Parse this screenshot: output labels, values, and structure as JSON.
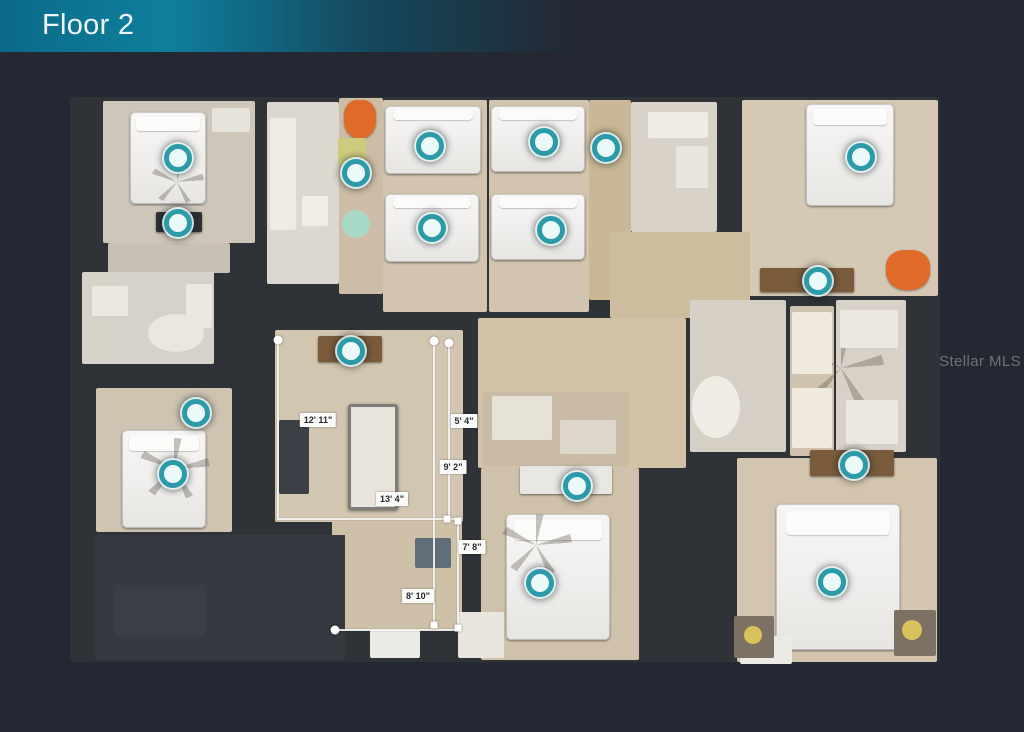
{
  "header": {
    "title": "Floor 2"
  },
  "watermark": {
    "text": "Stellar MLS"
  },
  "colors": {
    "background": "#232833",
    "banner_teal": "#0f7f9e",
    "wall_dark": "#2f3237",
    "floor_beige": "#d2c4ae",
    "marker_teal": "#2c9aa9",
    "measure_white": "#f4f4f2",
    "accent_orange": "#e06b28",
    "accent_red": "#d31520"
  },
  "plan": {
    "footprint": {
      "x": 70,
      "y": 97,
      "w": 870,
      "h": 565
    },
    "rooms": [
      {
        "name": "bedroom-top-left",
        "x": 103,
        "y": 101,
        "w": 152,
        "h": 142,
        "color": "#cfc6ba"
      },
      {
        "name": "hall-top-left-lower",
        "x": 108,
        "y": 243,
        "w": 122,
        "h": 30,
        "color": "#c9c0b4"
      },
      {
        "name": "bathroom-left",
        "x": 82,
        "y": 272,
        "w": 132,
        "h": 92,
        "color": "#d6d1c9"
      },
      {
        "name": "bedroom-bottom-left",
        "x": 96,
        "y": 388,
        "w": 136,
        "h": 144,
        "color": "#cfc3b2"
      },
      {
        "name": "bathroom-center-left",
        "x": 267,
        "y": 102,
        "w": 72,
        "h": 182,
        "color": "#dcd7cf"
      },
      {
        "name": "hall-top-center",
        "x": 339,
        "y": 98,
        "w": 44,
        "h": 196,
        "color": "#cdbda6"
      },
      {
        "name": "bedroom-mid-left",
        "x": 383,
        "y": 100,
        "w": 104,
        "h": 212,
        "color": "#d2c4ae"
      },
      {
        "name": "bedroom-mid",
        "x": 489,
        "y": 100,
        "w": 100,
        "h": 212,
        "color": "#d2c4ae"
      },
      {
        "name": "hall-mid",
        "x": 589,
        "y": 100,
        "w": 42,
        "h": 200,
        "color": "#c9b795"
      },
      {
        "name": "bathroom-top-right",
        "x": 631,
        "y": 102,
        "w": 86,
        "h": 130,
        "color": "#d8d2c8"
      },
      {
        "name": "bedroom-top-right",
        "x": 742,
        "y": 100,
        "w": 196,
        "h": 196,
        "color": "#d5c8b4"
      },
      {
        "name": "hall-upper-right",
        "x": 610,
        "y": 232,
        "w": 140,
        "h": 86,
        "color": "#cdbd9f"
      },
      {
        "name": "loft",
        "x": 275,
        "y": 330,
        "w": 188,
        "h": 192,
        "color": "#d3c6b0"
      },
      {
        "name": "loft-lower",
        "x": 332,
        "y": 520,
        "w": 130,
        "h": 110,
        "color": "#cfc0a8"
      },
      {
        "name": "corridor-center",
        "x": 478,
        "y": 318,
        "w": 208,
        "h": 150,
        "color": "#d2c2a6"
      },
      {
        "name": "bathroom-bottom-center",
        "x": 483,
        "y": 392,
        "w": 146,
        "h": 74,
        "color": "#cabca4"
      },
      {
        "name": "bedroom-bottom-center",
        "x": 481,
        "y": 468,
        "w": 158,
        "h": 192,
        "color": "#d0c2aa"
      },
      {
        "name": "bath-suite-left",
        "x": 690,
        "y": 300,
        "w": 96,
        "h": 152,
        "color": "#d5cfc5"
      },
      {
        "name": "bath-suite-vanity",
        "x": 790,
        "y": 306,
        "w": 44,
        "h": 150,
        "color": "#cfc3ae"
      },
      {
        "name": "bath-suite-right",
        "x": 836,
        "y": 300,
        "w": 70,
        "h": 152,
        "color": "#d7d1c7"
      },
      {
        "name": "bedroom-bottom-right",
        "x": 737,
        "y": 458,
        "w": 200,
        "h": 204,
        "color": "#d3c5ae"
      }
    ],
    "furniture": [
      {
        "type": "patch",
        "name": "attic-roof-area",
        "x": 95,
        "y": 535,
        "w": 250,
        "h": 125,
        "color": "#36393f"
      },
      {
        "type": "stairs",
        "name": "stairwell",
        "x": 115,
        "y": 585,
        "w": 90,
        "h": 52,
        "color": "#3b3e44"
      },
      {
        "type": "bed",
        "name": "bed",
        "x": 130,
        "y": 112,
        "w": 76,
        "h": 92
      },
      {
        "type": "bed",
        "name": "bed",
        "x": 385,
        "y": 106,
        "w": 96,
        "h": 68
      },
      {
        "type": "bed",
        "name": "bed",
        "x": 385,
        "y": 194,
        "w": 94,
        "h": 68
      },
      {
        "type": "bed",
        "name": "bed",
        "x": 491,
        "y": 106,
        "w": 94,
        "h": 66
      },
      {
        "type": "bed",
        "name": "bed",
        "x": 491,
        "y": 194,
        "w": 94,
        "h": 66
      },
      {
        "type": "bed",
        "name": "bed",
        "x": 806,
        "y": 104,
        "w": 88,
        "h": 102
      },
      {
        "type": "bed",
        "name": "bed",
        "x": 122,
        "y": 430,
        "w": 84,
        "h": 98
      },
      {
        "type": "bed",
        "name": "bed",
        "x": 506,
        "y": 514,
        "w": 104,
        "h": 126
      },
      {
        "type": "bed",
        "name": "bed",
        "x": 776,
        "y": 504,
        "w": 124,
        "h": 146
      },
      {
        "type": "fan",
        "name": "ceiling-fan-shadow",
        "x": 150,
        "y": 160,
        "w": 54,
        "h": 44
      },
      {
        "type": "fan",
        "name": "ceiling-fan-shadow",
        "x": 798,
        "y": 330,
        "w": 86,
        "h": 76
      },
      {
        "type": "fan",
        "name": "ceiling-fan-shadow",
        "x": 138,
        "y": 438,
        "w": 72,
        "h": 62
      },
      {
        "type": "fan",
        "name": "ceiling-fan-shadow",
        "x": 500,
        "y": 514,
        "w": 72,
        "h": 62
      },
      {
        "type": "desk",
        "name": "dresser",
        "x": 156,
        "y": 212,
        "w": 46,
        "h": 20,
        "color": "#2e3134"
      },
      {
        "type": "desk",
        "name": "loft-desk",
        "x": 318,
        "y": 336,
        "w": 64,
        "h": 26,
        "color": "#7a5c3c"
      },
      {
        "type": "desk",
        "name": "desk",
        "x": 760,
        "y": 268,
        "w": 94,
        "h": 24,
        "color": "#7a5c3c"
      },
      {
        "type": "desk",
        "name": "desk",
        "x": 810,
        "y": 450,
        "w": 84,
        "h": 26,
        "color": "#7a5c3c"
      },
      {
        "type": "desk",
        "name": "desk",
        "x": 520,
        "y": 466,
        "w": 92,
        "h": 28,
        "color": "#e9e7e1"
      },
      {
        "type": "table",
        "name": "pool-table",
        "x": 348,
        "y": 404,
        "w": 50,
        "h": 106,
        "color": "#e8e4dc"
      },
      {
        "type": "shelf",
        "name": "shelf",
        "x": 279,
        "y": 420,
        "w": 30,
        "h": 74,
        "color": "#3c4046"
      },
      {
        "type": "cabinet",
        "name": "cabinet",
        "x": 415,
        "y": 538,
        "w": 36,
        "h": 30,
        "color": "#5f6e78"
      },
      {
        "type": "chair",
        "name": "orange-chair",
        "x": 344,
        "y": 100,
        "w": 32,
        "h": 38,
        "color": "#e06b28"
      },
      {
        "type": "chair",
        "name": "orange-chair",
        "x": 886,
        "y": 250,
        "w": 44,
        "h": 40,
        "color": "#e06b28"
      },
      {
        "type": "flower",
        "name": "red-flower-rug",
        "x": 584,
        "y": 184,
        "w": 46,
        "h": 50,
        "color": "#d31520"
      },
      {
        "type": "stool",
        "name": "green-stool",
        "x": 342,
        "y": 210,
        "w": 28,
        "h": 28,
        "color": "#a8d8c6"
      },
      {
        "type": "mat",
        "name": "yellow-mat",
        "x": 338,
        "y": 138,
        "w": 28,
        "h": 26,
        "color": "#cfcb7e"
      },
      {
        "type": "tub",
        "name": "bathtub",
        "x": 692,
        "y": 376,
        "w": 48,
        "h": 62,
        "color": "#efece6"
      },
      {
        "type": "tub",
        "name": "bathtub",
        "x": 148,
        "y": 314,
        "w": 56,
        "h": 38,
        "color": "#eae7e1"
      },
      {
        "type": "fixture",
        "name": "bath-fixture",
        "x": 92,
        "y": 286,
        "w": 36,
        "h": 30,
        "color": "#ebe8e2"
      },
      {
        "type": "fixture",
        "name": "bath-fixture",
        "x": 186,
        "y": 284,
        "w": 26,
        "h": 44,
        "color": "#ebe8e2"
      },
      {
        "type": "fixture",
        "name": "bath-counter",
        "x": 270,
        "y": 118,
        "w": 26,
        "h": 112,
        "color": "#eeebe5"
      },
      {
        "type": "fixture",
        "name": "toilet",
        "x": 302,
        "y": 196,
        "w": 26,
        "h": 30,
        "color": "#f0ede7"
      },
      {
        "type": "fixture",
        "name": "bath-counter",
        "x": 648,
        "y": 112,
        "w": 60,
        "h": 26,
        "color": "#efece6"
      },
      {
        "type": "fixture",
        "name": "shower",
        "x": 676,
        "y": 146,
        "w": 32,
        "h": 42,
        "color": "#e9e6df"
      },
      {
        "type": "fixture",
        "name": "shower",
        "x": 492,
        "y": 396,
        "w": 60,
        "h": 44,
        "color": "#e7e2d8"
      },
      {
        "type": "fixture",
        "name": "bath-fixture",
        "x": 560,
        "y": 420,
        "w": 56,
        "h": 34,
        "color": "#ded8cc"
      },
      {
        "type": "vanity",
        "name": "vanity",
        "x": 792,
        "y": 312,
        "w": 40,
        "h": 62,
        "color": "#efe9de"
      },
      {
        "type": "vanity",
        "name": "vanity",
        "x": 792,
        "y": 388,
        "w": 40,
        "h": 60,
        "color": "#efe9de"
      },
      {
        "type": "fixture",
        "name": "bath-fixture",
        "x": 840,
        "y": 310,
        "w": 58,
        "h": 38,
        "color": "#ece8e0"
      },
      {
        "type": "fixture",
        "name": "bath-fixture",
        "x": 846,
        "y": 400,
        "w": 52,
        "h": 44,
        "color": "#ece8e0"
      },
      {
        "type": "fixture",
        "name": "closet-shelf",
        "x": 212,
        "y": 108,
        "w": 38,
        "h": 24,
        "color": "#e5e2da"
      },
      {
        "type": "bench",
        "name": "bench",
        "x": 370,
        "y": 630,
        "w": 50,
        "h": 28,
        "color": "#eceae4"
      },
      {
        "type": "bench",
        "name": "bench",
        "x": 458,
        "y": 612,
        "w": 46,
        "h": 46,
        "color": "#e9e6de"
      },
      {
        "type": "bench",
        "name": "bench",
        "x": 740,
        "y": 636,
        "w": 52,
        "h": 28,
        "color": "#eceae4"
      },
      {
        "type": "nightstand",
        "name": "nightstand",
        "x": 734,
        "y": 616,
        "w": 40,
        "h": 42,
        "color": "#7b7264"
      },
      {
        "type": "lamp",
        "name": "lamp",
        "x": 744,
        "y": 626,
        "w": 18,
        "h": 18,
        "color": "#d9c25c"
      },
      {
        "type": "nightstand",
        "name": "nightstand",
        "x": 894,
        "y": 610,
        "w": 42,
        "h": 46,
        "color": "#7b7264"
      },
      {
        "type": "lamp",
        "name": "lamp",
        "x": 902,
        "y": 620,
        "w": 20,
        "h": 20,
        "color": "#d9c25c"
      }
    ],
    "markers": [
      {
        "x": 178,
        "y": 158
      },
      {
        "x": 178,
        "y": 223
      },
      {
        "x": 356,
        "y": 173
      },
      {
        "x": 430,
        "y": 146
      },
      {
        "x": 432,
        "y": 228
      },
      {
        "x": 544,
        "y": 142
      },
      {
        "x": 606,
        "y": 148
      },
      {
        "x": 551,
        "y": 230
      },
      {
        "x": 861,
        "y": 157
      },
      {
        "x": 818,
        "y": 281
      },
      {
        "x": 351,
        "y": 351
      },
      {
        "x": 196,
        "y": 413
      },
      {
        "x": 173,
        "y": 474
      },
      {
        "x": 577,
        "y": 486
      },
      {
        "x": 540,
        "y": 583
      },
      {
        "x": 854,
        "y": 465
      },
      {
        "x": 832,
        "y": 582
      }
    ],
    "measurements": {
      "lines": [
        {
          "x": 277,
          "y": 340,
          "w": 2,
          "h": 180
        },
        {
          "x": 433,
          "y": 340,
          "w": 2,
          "h": 287
        },
        {
          "x": 448,
          "y": 342,
          "w": 2,
          "h": 178
        },
        {
          "x": 277,
          "y": 518,
          "w": 183,
          "h": 2
        },
        {
          "x": 457,
          "y": 520,
          "w": 2,
          "h": 109
        },
        {
          "x": 334,
          "y": 629,
          "w": 124,
          "h": 2
        }
      ],
      "labels": [
        {
          "text": "12' 11\"",
          "x": 318,
          "y": 420
        },
        {
          "text": "5' 4\"",
          "x": 464,
          "y": 421
        },
        {
          "text": "9' 2\"",
          "x": 453,
          "y": 467
        },
        {
          "text": "13' 4\"",
          "x": 392,
          "y": 499
        },
        {
          "text": "7' 8\"",
          "x": 472,
          "y": 547
        },
        {
          "text": "8' 10\"",
          "x": 418,
          "y": 596
        }
      ],
      "handles": [
        {
          "shape": "circle",
          "x": 278,
          "y": 340
        },
        {
          "shape": "circle",
          "x": 434,
          "y": 341
        },
        {
          "shape": "circle",
          "x": 449,
          "y": 343
        },
        {
          "shape": "circle",
          "x": 335,
          "y": 630
        },
        {
          "shape": "square",
          "x": 447,
          "y": 519
        },
        {
          "shape": "square",
          "x": 458,
          "y": 521
        },
        {
          "shape": "square",
          "x": 434,
          "y": 625
        },
        {
          "shape": "square",
          "x": 458,
          "y": 628
        }
      ]
    }
  }
}
